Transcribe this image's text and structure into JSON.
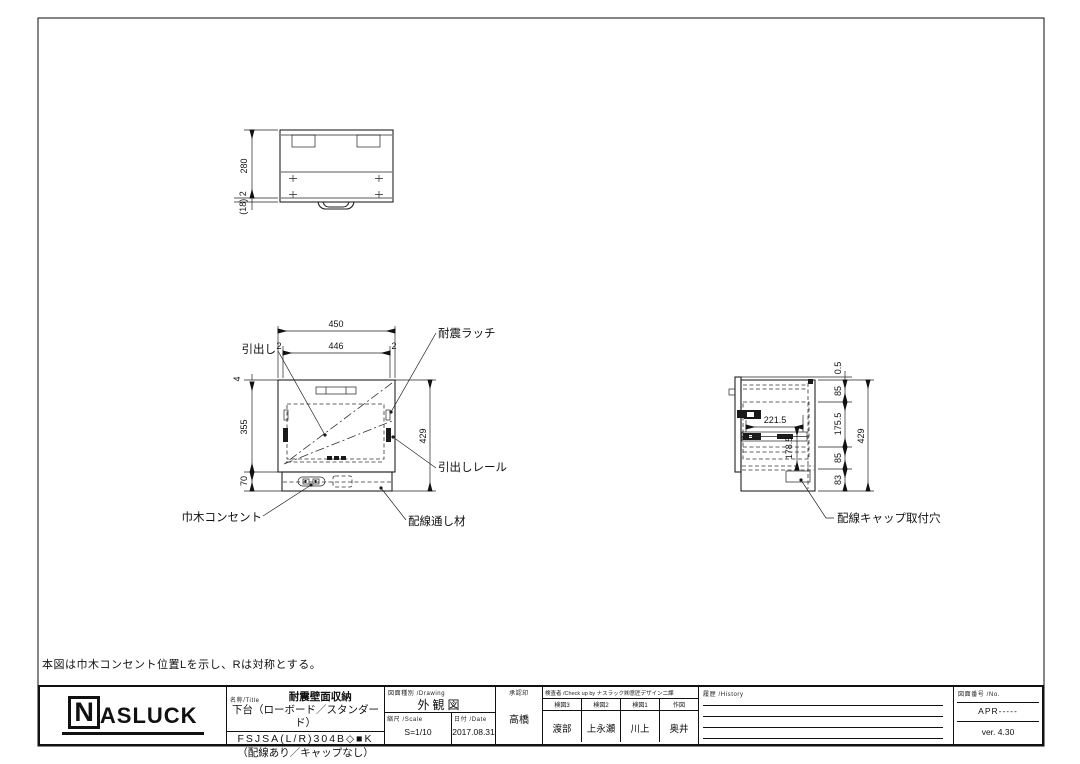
{
  "note": "本図は巾木コンセント位置Lを示し、Rは対称とする。",
  "drawing": {
    "top_view": {
      "dim_depth": "280",
      "dim_front": "(18) 2"
    },
    "front_view": {
      "dim_width": "450",
      "dim_edge_l": "2",
      "dim_inner": "446",
      "dim_edge_r": "2",
      "dim_top": "4",
      "dim_body": "355",
      "dim_plinth": "70",
      "dim_height": "429",
      "label_drawer": "引出し",
      "label_latch": "耐震ラッチ",
      "label_rail": "引出しレール",
      "label_outlet": "巾木コンセント",
      "label_wire": "配線通し材"
    },
    "side_view": {
      "dim_gap": "0.5",
      "dim_s1": "85",
      "dim_s2": "175.5",
      "dim_s3": "85",
      "dim_s4": "83",
      "dim_height": "429",
      "dim_rail": "221.5",
      "dim_inner_h": "178.5",
      "label_cap": "配線キャップ取付穴"
    }
  },
  "title_block": {
    "logo_n": "N",
    "logo_rest": "ASLUCK",
    "name_label": "名称/Title",
    "title_line1": "耐震壁面収納",
    "title_line2": "下台（ローボード／スタンダード）",
    "code_line": "FSJSA(L/R)304B◇■K",
    "code_note": "（配線あり／キャップなし）",
    "drawing_label": "図面種別 /Drawing",
    "drawing_value": "外観図",
    "scale_label": "縮尺 /Scale",
    "scale_value": "S=1/10",
    "date_label": "日付 /Date",
    "date_value": "2017.08.31",
    "approval_label": "承認印",
    "approval_value": "高橋",
    "check_label": "検査者 /Check up by ナスラック㈱意匠デザイン二課",
    "checkers": [
      {
        "role": "検図3",
        "name": "渡部"
      },
      {
        "role": "検図2",
        "name": "上永瀬"
      },
      {
        "role": "検図1",
        "name": "川上"
      },
      {
        "role": "作図",
        "name": "奥井"
      }
    ],
    "history_label": "履歴 /History",
    "number_label": "図面番号 /No.",
    "number_value": "APR-----",
    "version_value": "ver. 4.30"
  }
}
